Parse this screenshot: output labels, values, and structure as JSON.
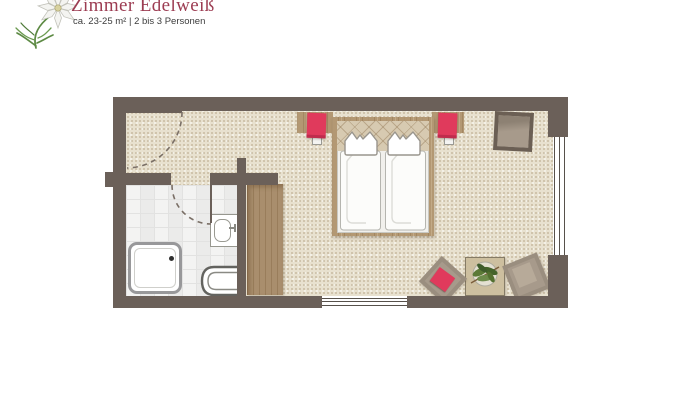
{
  "header": {
    "title": "Zimmer Edelweiß",
    "subtitle": "ca. 23-25 m² | 2 bis 3 Personen",
    "logo": "edelweiss-flower-icon"
  },
  "palette": {
    "background": "#ffffff",
    "title_text": "#9c3c52",
    "subtitle_text": "#3d3d3d",
    "wall": "#6b6059",
    "floor": "#e8e1cf",
    "tile": "#f8f8f7",
    "tile_line": "#e2e2e1",
    "wood": "#b39873",
    "table_beige": "#cdbf9f",
    "accent_red": "#e03a5c",
    "furniture_taupe": "#a79a8b",
    "outline_gray": "#97978f",
    "plant_green": "#53702f"
  },
  "floorplan": {
    "rooms": [
      "entry",
      "bathroom",
      "bedroom"
    ],
    "doors": [
      "entrance-door",
      "bathroom-door"
    ],
    "windows": [
      "right-wall-window",
      "bottom-wall-window"
    ],
    "furniture": [
      "double-bed",
      "bedside-shelf-left",
      "bedside-shelf-right",
      "bedside-lamp-left",
      "bedside-lamp-right",
      "wardrobe",
      "luggage-stool",
      "side-table",
      "potted-plant",
      "armchair-with-red-cushion",
      "armchair-right",
      "shower",
      "washbasin",
      "toilet"
    ]
  }
}
